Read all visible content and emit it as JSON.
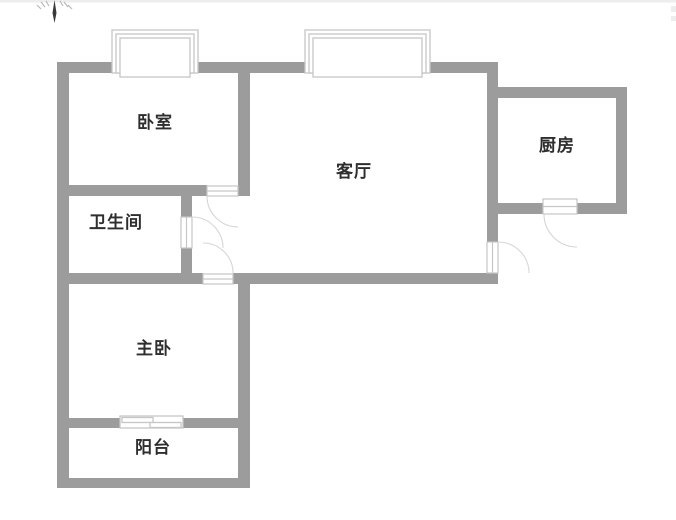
{
  "rooms": [
    {
      "id": "bedroom",
      "label": "卧室"
    },
    {
      "id": "living-room",
      "label": "客厅"
    },
    {
      "id": "kitchen",
      "label": "厨房"
    },
    {
      "id": "bathroom",
      "label": "卫生间"
    },
    {
      "id": "master-bedroom",
      "label": "主卧"
    },
    {
      "id": "balcony",
      "label": "阳台"
    }
  ],
  "icons": {
    "north_arrow": "compass-north-needle"
  },
  "colors": {
    "wall": "#9c9c9c",
    "frame": "#c6c6c6",
    "arc": "#d6d6d6",
    "text": "#2e2e2e",
    "needle": "#3a3a3a",
    "edge_artifact": "#ededed",
    "background": "#ffffff"
  },
  "elements": {
    "windows": [
      "bedroom-bay-window",
      "living-room-bay-window",
      "balcony-sliding-window"
    ],
    "doors": [
      "bedroom-door",
      "bathroom-door",
      "master-bedroom-door",
      "entry-door",
      "kitchen-door"
    ]
  }
}
